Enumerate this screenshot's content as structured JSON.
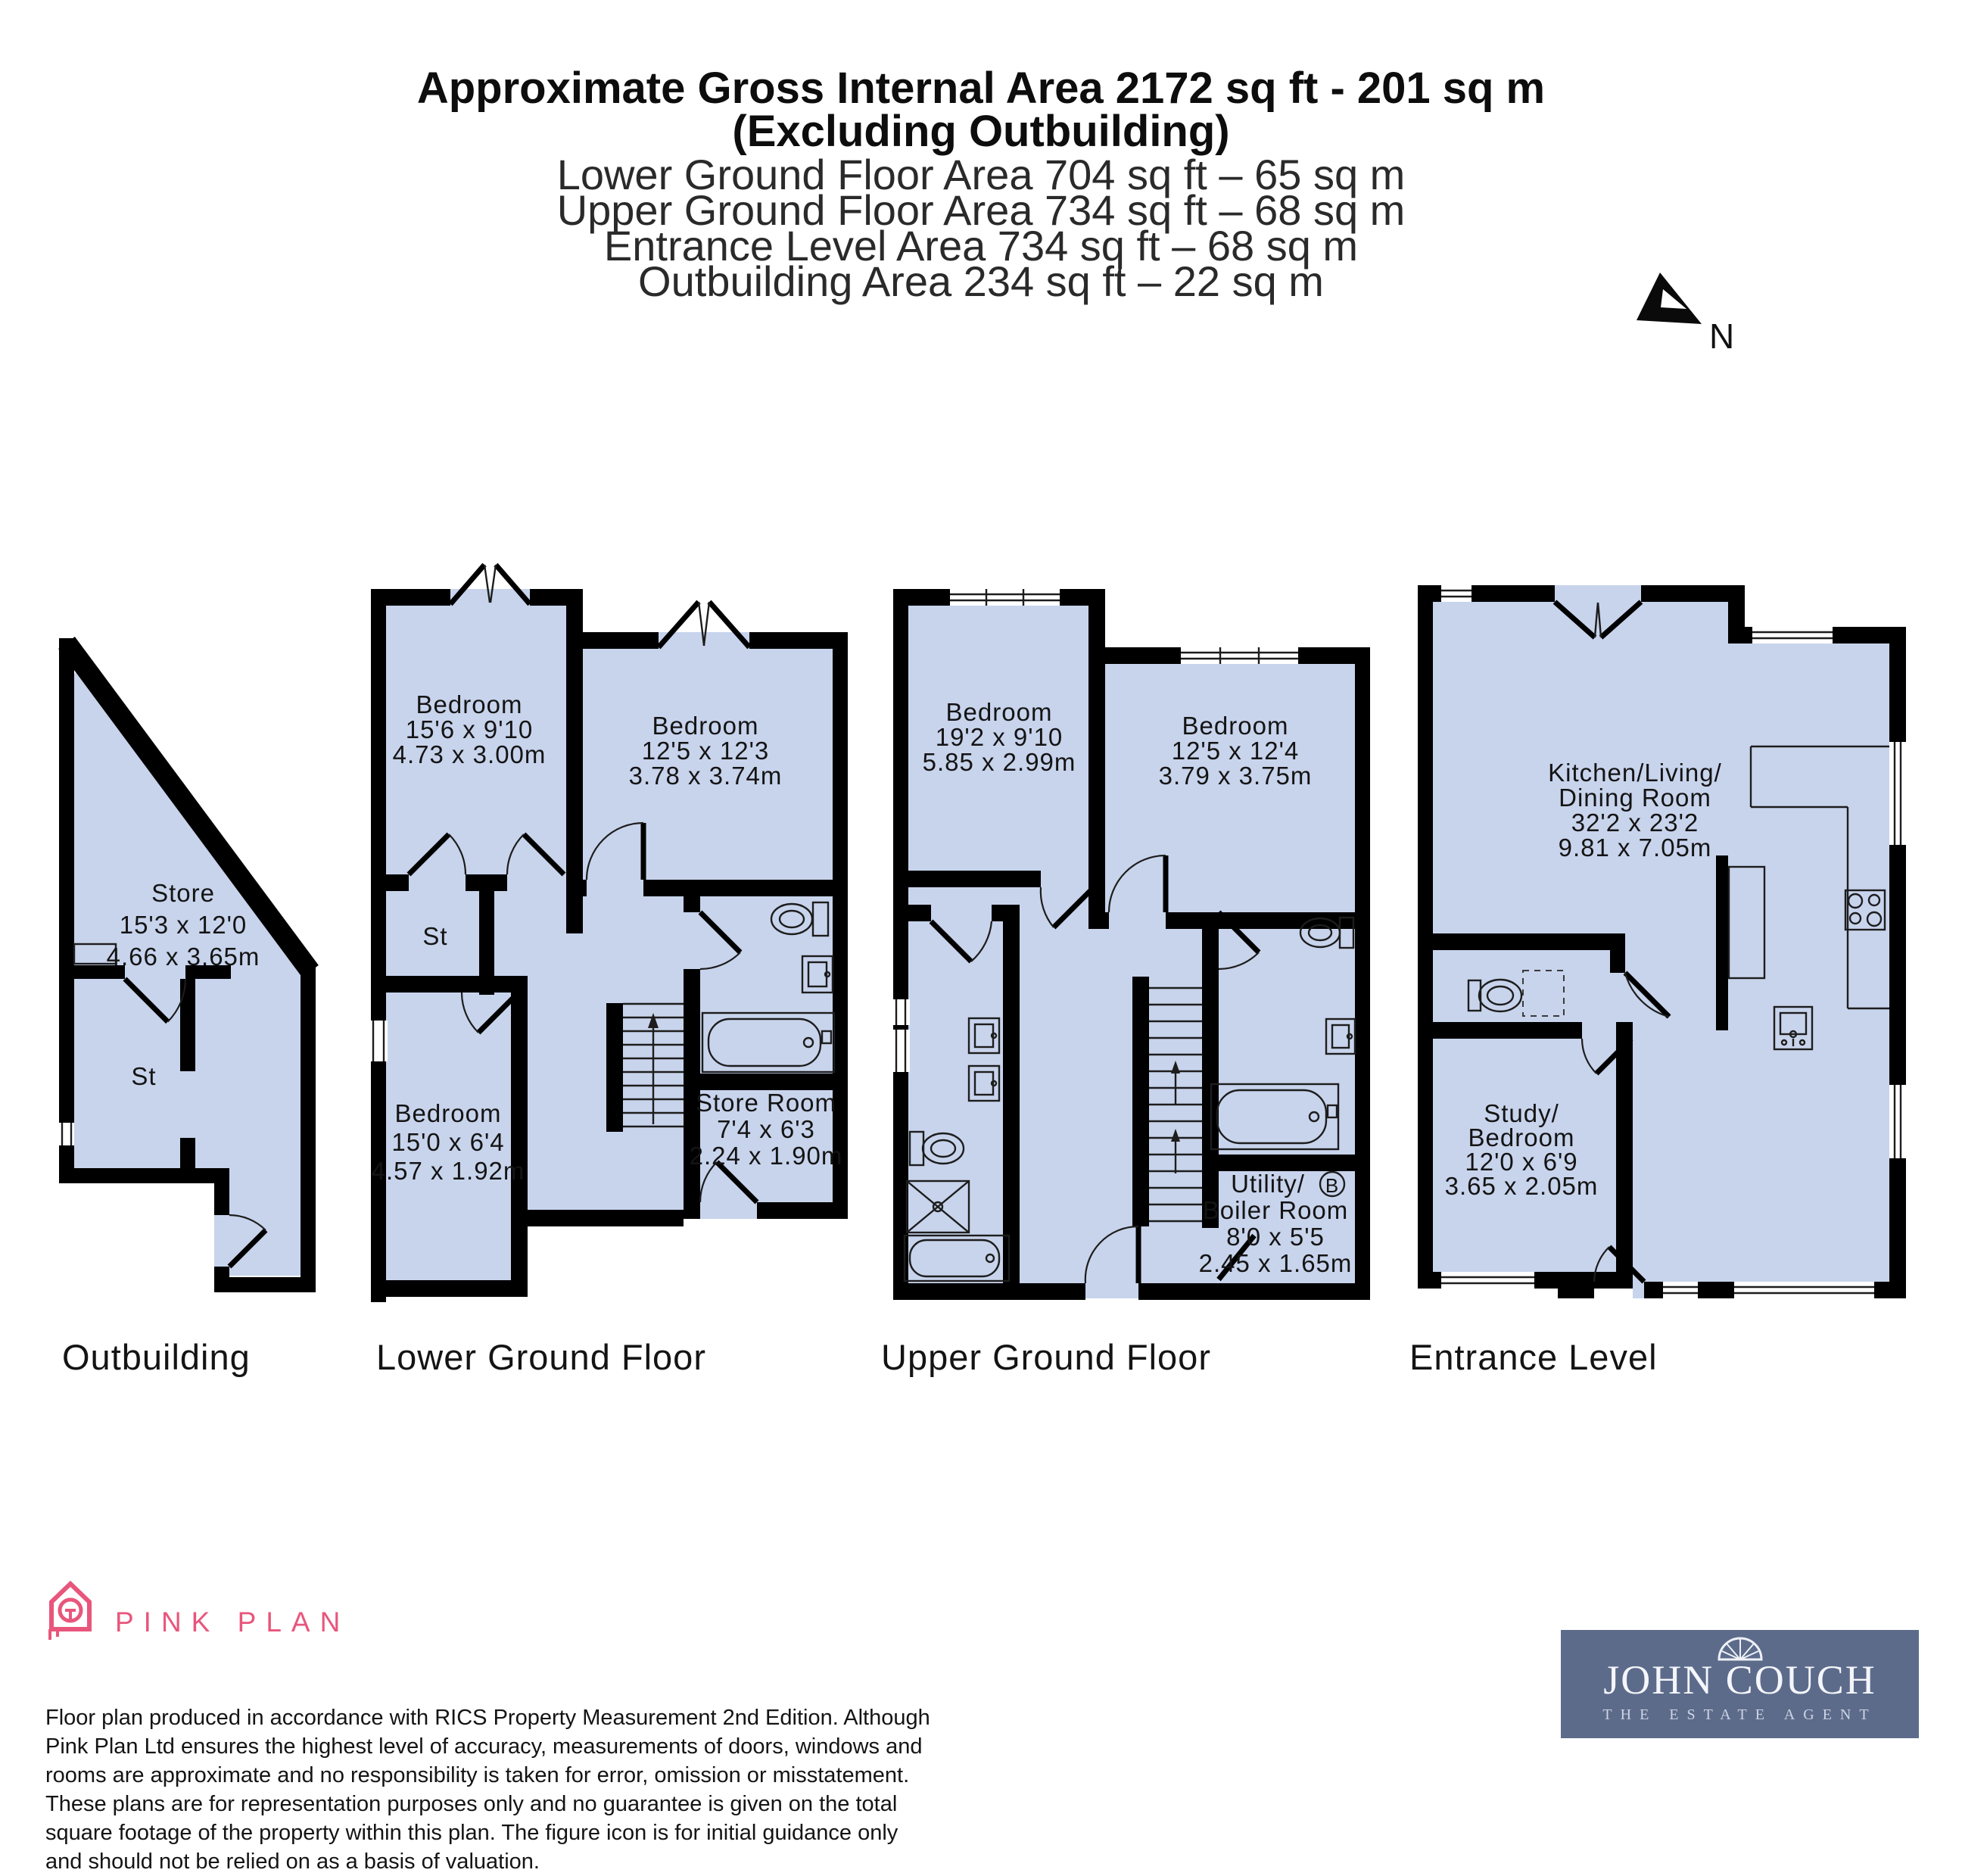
{
  "header": {
    "title_bold_1": "Approximate Gross Internal Area 2172 sq ft - 201 sq m",
    "title_bold_2": "(Excluding Outbuilding)",
    "area_lines": {
      "lower": "Lower Ground Floor Area 704 sq ft – 65 sq m",
      "upper": "Upper Ground Floor Area 734 sq ft – 68 sq m",
      "entrance": "Entrance Level Area 734 sq ft – 68 sq m",
      "outbuilding": "Outbuilding Area 234 sq ft – 22 sq m"
    }
  },
  "compass": {
    "north_label": "N"
  },
  "floors": {
    "outbuilding": {
      "label": "Outbuilding",
      "rooms": {
        "store": {
          "name": "Store",
          "imperial": "15'3 x 12'0",
          "metric": "4.66 x 3.65m"
        },
        "st": {
          "name": "St"
        }
      }
    },
    "lower_ground": {
      "label": "Lower Ground Floor",
      "rooms": {
        "bedroom_1": {
          "name": "Bedroom",
          "imperial": "15'6 x 9'10",
          "metric": "4.73 x 3.00m"
        },
        "bedroom_2": {
          "name": "Bedroom",
          "imperial": "12'5 x 12'3",
          "metric": "3.78 x 3.74m"
        },
        "st": {
          "name": "St"
        },
        "bedroom_3": {
          "name": "Bedroom",
          "imperial": "15'0 x 6'4",
          "metric": "4.57 x 1.92m"
        },
        "store_room": {
          "name": "Store Room",
          "imperial": "7'4 x 6'3",
          "metric": "2.24 x 1.90m"
        }
      }
    },
    "upper_ground": {
      "label": "Upper Ground Floor",
      "rooms": {
        "bedroom_1": {
          "name": "Bedroom",
          "imperial": "19'2 x 9'10",
          "metric": "5.85 x 2.99m"
        },
        "bedroom_2": {
          "name": "Bedroom",
          "imperial": "12'5 x 12'4",
          "metric": "3.79 x 3.75m"
        },
        "utility": {
          "name_1": "Utility/",
          "name_2": "Boiler Room",
          "imperial": "8'0 x 5'5",
          "metric": "2.45 x 1.65m",
          "boiler_badge": "B"
        }
      }
    },
    "entrance": {
      "label": "Entrance Level",
      "rooms": {
        "kitchen": {
          "name_1": "Kitchen/Living/",
          "name_2": "Dining Room",
          "imperial": "32'2 x 23'2",
          "metric": "9.81 x 7.05m"
        },
        "study": {
          "name_1": "Study/",
          "name_2": "Bedroom",
          "imperial": "12'0 x 6'9",
          "metric": "3.65 x 2.05m"
        }
      }
    }
  },
  "footer": {
    "producer": {
      "name": "PINK PLAN"
    },
    "disclaimer": "Floor plan produced in accordance with RICS Property Measurement 2nd Edition. Although Pink Plan Ltd ensures the highest level of accuracy, measurements of doors, windows and rooms are approximate and no responsibility is taken for error, omission or misstatement. These plans are for representation purposes only and no guarantee is given on the total square footage of the property within this plan. The figure icon is for initial guidance only and should not be relied on as a basis of valuation.",
    "agent": {
      "name": "JOHN COUCH",
      "tagline": "THE ESTATE AGENT"
    }
  },
  "colors": {
    "room_fill": "#c8d4ec",
    "wall": "#000000",
    "brand_pink": "#e8567c",
    "agent_bg": "#5d6b8b"
  }
}
